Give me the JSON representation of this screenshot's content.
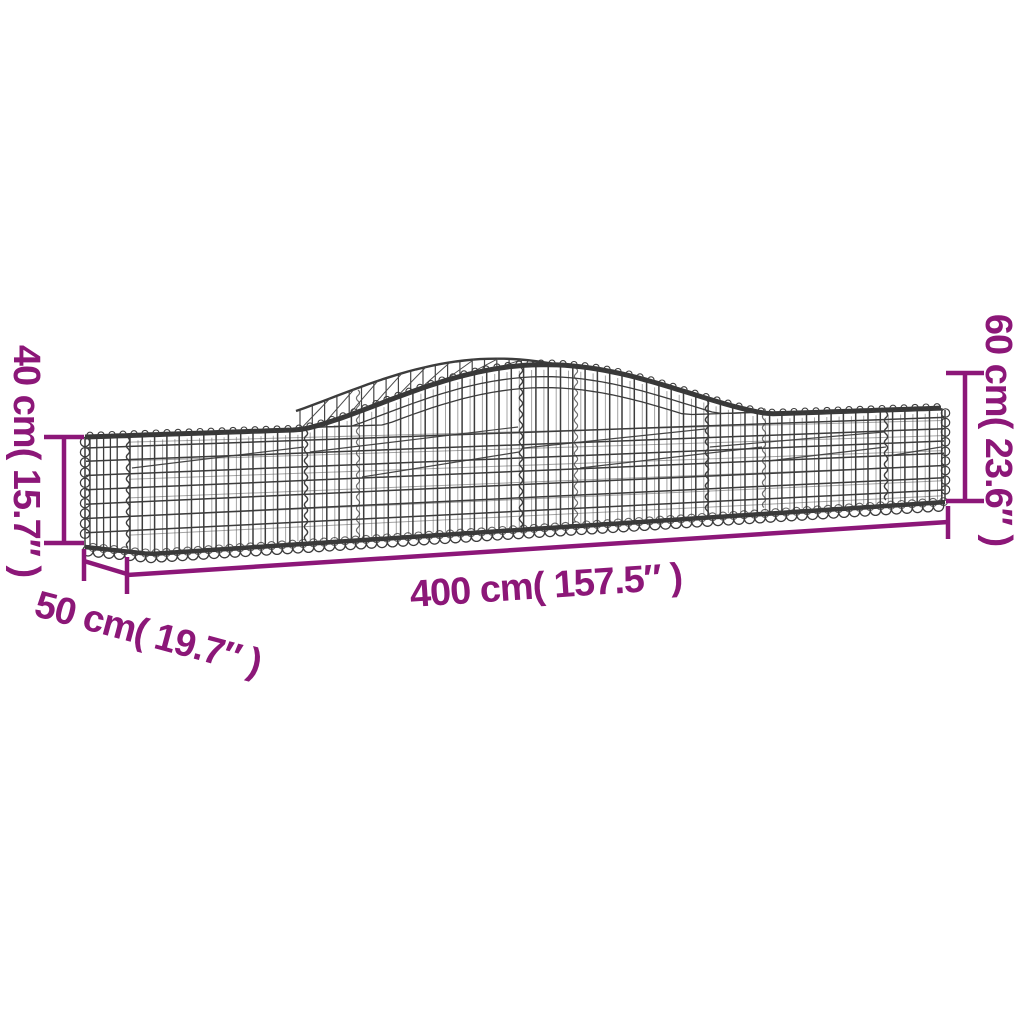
{
  "diagram": {
    "subject": "arched gabion basket wire-mesh wireframe drawing",
    "dimensions": {
      "height_left": "40 cm( 15.7″ )",
      "height_right": "60 cm( 23.6″ )",
      "length": "400 cm( 157.5″ )",
      "depth": "50 cm( 19.7″ )"
    },
    "colors": {
      "dimension_accent": "#8C1778",
      "wire": "#3C3C3C",
      "wire_light": "#5A5A5A",
      "background": "#FFFFFF"
    }
  }
}
